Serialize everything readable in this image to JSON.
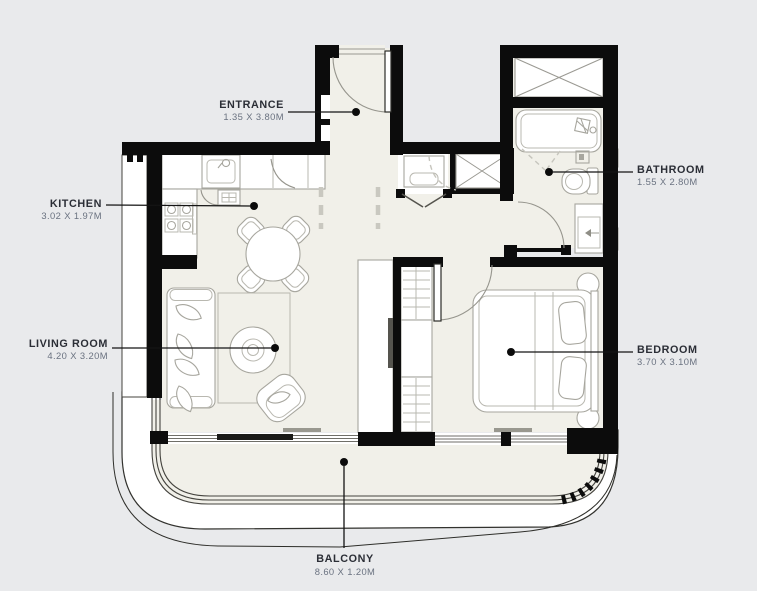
{
  "floorplan": {
    "colors": {
      "background": "#e9eaec",
      "floor": "#f1f0e9",
      "wall": "#0c0c0c",
      "furniture_line": "#a7a69e",
      "label_name": "#2b2e36",
      "label_dims": "#6a7280"
    },
    "labels": {
      "entrance": {
        "name": "ENTRANCE",
        "dimensions": "1.35 X 3.80M"
      },
      "kitchen": {
        "name": "KITCHEN",
        "dimensions": "3.02 X 1.97M"
      },
      "living_room": {
        "name": "LIVING ROOM",
        "dimensions": "4.20 X 3.20M"
      },
      "bathroom": {
        "name": "BATHROOM",
        "dimensions": "1.55 X 2.80M"
      },
      "bedroom": {
        "name": "BEDROOM",
        "dimensions": "3.70 X 3.10M"
      },
      "balcony": {
        "name": "BALCONY",
        "dimensions": "8.60 X 1.20M"
      }
    }
  }
}
